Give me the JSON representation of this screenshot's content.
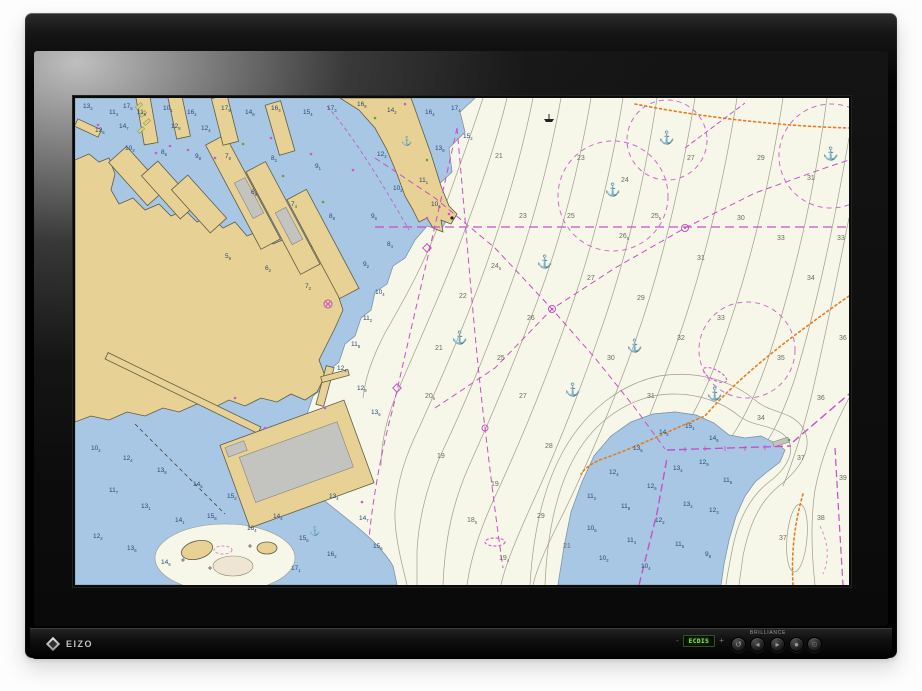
{
  "device": {
    "brand": "EIZO",
    "bottom_panel": {
      "display_label": "ECDIS",
      "minus_label": "-",
      "plus_label": "+",
      "brilliance_label": "BRILLIANCE",
      "buttons": [
        {
          "name": "return-button",
          "glyph": "↺"
        },
        {
          "name": "brilliance-down-button",
          "glyph": "◂"
        },
        {
          "name": "brilliance-up-button",
          "glyph": "▸"
        },
        {
          "name": "enter-button",
          "glyph": "●"
        },
        {
          "name": "power-button",
          "glyph": "⊙"
        }
      ]
    }
  },
  "chart": {
    "description": "ECDIS nautical harbour chart: shallow water blue, land tan, deep water white with contours, magenta cable and anchorage lines, orange pipelines, depth soundings",
    "palette": {
      "shallow_water": "#a7c7e5",
      "deep_water": "#f6f7e9",
      "land": "#e8d194",
      "building_gray": "#c3c3c0",
      "contour_gray": "#a09c8b",
      "cable_magenta": "#c94fc9",
      "pipeline_orange": "#ea7c20",
      "ecdis_green": "#8fe457"
    },
    "anchor_symbol": "⚓",
    "anchorages_pale": [
      [
        538,
        96
      ],
      [
        592,
        44
      ],
      [
        470,
        168
      ],
      [
        560,
        252
      ],
      [
        385,
        244
      ],
      [
        640,
        300
      ],
      [
        756,
        60
      ],
      [
        498,
        296
      ]
    ],
    "anchorages_dark": [
      [
        332,
        46
      ],
      [
        240,
        436
      ]
    ],
    "soundings_shallow": [
      [
        8,
        10,
        "13|2"
      ],
      [
        34,
        16,
        "11|4"
      ],
      [
        20,
        34,
        "12|6"
      ],
      [
        48,
        10,
        "17|5"
      ],
      [
        62,
        16,
        "11|9"
      ],
      [
        44,
        30,
        "14|7"
      ],
      [
        88,
        12,
        "10|1"
      ],
      [
        112,
        16,
        "16|2"
      ],
      [
        96,
        30,
        "12|8"
      ],
      [
        126,
        32,
        "12|4"
      ],
      [
        146,
        12,
        "17|9"
      ],
      [
        170,
        16,
        "14|8"
      ],
      [
        196,
        12,
        "16|3"
      ],
      [
        228,
        16,
        "15|4"
      ],
      [
        252,
        12,
        "17|3"
      ],
      [
        282,
        8,
        "16|8"
      ],
      [
        312,
        14,
        "14|2"
      ],
      [
        350,
        16,
        "16|4"
      ],
      [
        376,
        12,
        "17|4"
      ],
      [
        388,
        40,
        "15|2"
      ],
      [
        360,
        52,
        "13|8"
      ],
      [
        344,
        84,
        "11|1"
      ],
      [
        356,
        108,
        "10|6"
      ],
      [
        302,
        58,
        "12|2"
      ],
      [
        318,
        92,
        "10|2"
      ],
      [
        296,
        120,
        "9|6"
      ],
      [
        312,
        148,
        "8|4"
      ],
      [
        288,
        168,
        "9|2"
      ],
      [
        300,
        196,
        "10|4"
      ],
      [
        288,
        222,
        "11|2"
      ],
      [
        276,
        248,
        "11|8"
      ],
      [
        262,
        272,
        "12|4"
      ],
      [
        282,
        292,
        "12|9"
      ],
      [
        296,
        316,
        "13|6"
      ],
      [
        120,
        60,
        "9|8"
      ],
      [
        86,
        56,
        "8|6"
      ],
      [
        50,
        52,
        "10|3"
      ],
      [
        150,
        60,
        "7|9"
      ],
      [
        196,
        62,
        "8|2"
      ],
      [
        240,
        70,
        "9|1"
      ],
      [
        176,
        96,
        "6|8"
      ],
      [
        216,
        108,
        "7|4"
      ],
      [
        254,
        120,
        "8|8"
      ],
      [
        150,
        160,
        "5|8"
      ],
      [
        190,
        172,
        "6|2"
      ],
      [
        230,
        190,
        "7|2"
      ],
      [
        16,
        352,
        "10|2"
      ],
      [
        48,
        362,
        "12|4"
      ],
      [
        82,
        374,
        "13|8"
      ],
      [
        118,
        388,
        "14|5"
      ],
      [
        152,
        400,
        "15|2"
      ],
      [
        34,
        394,
        "11|7"
      ],
      [
        66,
        410,
        "13|1"
      ],
      [
        100,
        424,
        "14|1"
      ],
      [
        18,
        440,
        "12|2"
      ],
      [
        52,
        452,
        "13|6"
      ],
      [
        132,
        420,
        "15|8"
      ],
      [
        172,
        432,
        "16|4"
      ],
      [
        198,
        420,
        "14|4"
      ],
      [
        224,
        442,
        "15|6"
      ],
      [
        252,
        458,
        "16|2"
      ],
      [
        216,
        472,
        "17|1"
      ],
      [
        254,
        400,
        "13|4"
      ],
      [
        284,
        422,
        "14|7"
      ],
      [
        298,
        450,
        "15|5"
      ],
      [
        86,
        466,
        "14|9"
      ],
      [
        512,
        400,
        "11|2"
      ],
      [
        534,
        376,
        "12|4"
      ],
      [
        558,
        352,
        "13|5"
      ],
      [
        584,
        336,
        "14|2"
      ],
      [
        610,
        330,
        "15|1"
      ],
      [
        634,
        342,
        "14|6"
      ],
      [
        512,
        432,
        "10|6"
      ],
      [
        546,
        410,
        "11|8"
      ],
      [
        572,
        390,
        "12|6"
      ],
      [
        598,
        372,
        "13|4"
      ],
      [
        624,
        366,
        "12|9"
      ],
      [
        648,
        384,
        "11|6"
      ],
      [
        524,
        462,
        "10|2"
      ],
      [
        552,
        444,
        "11|4"
      ],
      [
        580,
        424,
        "12|2"
      ],
      [
        608,
        408,
        "13|2"
      ],
      [
        634,
        414,
        "12|3"
      ],
      [
        600,
        448,
        "11|5"
      ],
      [
        566,
        470,
        "10|4"
      ],
      [
        630,
        458,
        "9|8"
      ]
    ],
    "soundings_deep": [
      [
        420,
        60,
        "21"
      ],
      [
        444,
        120,
        "23"
      ],
      [
        416,
        170,
        "24|5"
      ],
      [
        452,
        222,
        "26"
      ],
      [
        422,
        262,
        "25"
      ],
      [
        444,
        300,
        "27"
      ],
      [
        470,
        350,
        "28"
      ],
      [
        462,
        420,
        "29"
      ],
      [
        492,
        120,
        "25"
      ],
      [
        512,
        182,
        "27"
      ],
      [
        544,
        140,
        "26|5"
      ],
      [
        562,
        202,
        "29"
      ],
      [
        532,
        262,
        "30"
      ],
      [
        572,
        300,
        "31"
      ],
      [
        602,
        242,
        "32"
      ],
      [
        642,
        222,
        "33"
      ],
      [
        622,
        162,
        "31"
      ],
      [
        662,
        122,
        "30"
      ],
      [
        702,
        142,
        "33"
      ],
      [
        732,
        182,
        "34"
      ],
      [
        702,
        262,
        "35"
      ],
      [
        742,
        302,
        "36"
      ],
      [
        682,
        322,
        "34"
      ],
      [
        722,
        362,
        "37"
      ],
      [
        742,
        422,
        "38"
      ],
      [
        704,
        442,
        "37"
      ],
      [
        612,
        62,
        "27"
      ],
      [
        682,
        62,
        "29"
      ],
      [
        732,
        82,
        "31"
      ],
      [
        762,
        142,
        "33"
      ],
      [
        764,
        242,
        "36"
      ],
      [
        502,
        62,
        "23"
      ],
      [
        546,
        84,
        "24"
      ],
      [
        384,
        200,
        "22"
      ],
      [
        360,
        252,
        "21"
      ],
      [
        350,
        300,
        "20|5"
      ],
      [
        362,
        360,
        "19"
      ],
      [
        392,
        424,
        "18|5"
      ],
      [
        424,
        462,
        "19|4"
      ],
      [
        764,
        382,
        "39"
      ],
      [
        576,
        120,
        "25|5"
      ],
      [
        416,
        388,
        "19"
      ],
      [
        488,
        450,
        "21"
      ]
    ]
  }
}
